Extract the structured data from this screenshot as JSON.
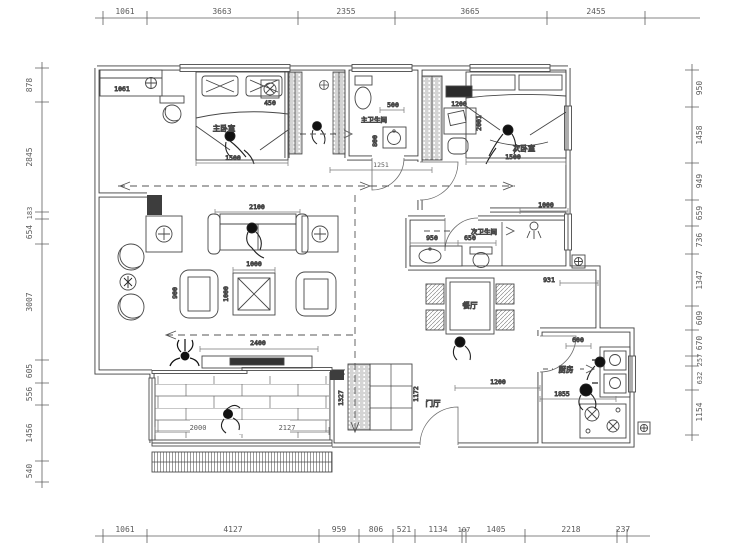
{
  "plan": {
    "type": "apartment-floor-plan",
    "units": "mm"
  },
  "dims": {
    "top": [
      "1061",
      "3663",
      "2355",
      "3665",
      "2455"
    ],
    "bottom": [
      "1061",
      "4127",
      "959",
      "806",
      "521",
      "1134",
      "107",
      "1405",
      "2218",
      "237"
    ],
    "left": [
      "878",
      "2845",
      "183",
      "654",
      "3007",
      "605",
      "556",
      "1456",
      "540"
    ],
    "right": [
      "950",
      "1458",
      "949",
      "659",
      "736",
      "1347",
      "609",
      "670",
      "257",
      "632",
      "1154"
    ],
    "interior": {
      "wardrobe": "1061",
      "fan": "450",
      "bed1": "1500",
      "bath1_w": "500",
      "bath1_d": "800",
      "hall": "1251",
      "desk": "1200",
      "bed2_len": "2001",
      "bed2_w": "1500",
      "sofa": "2100",
      "ctable_w": "1000",
      "ctable_h": "1000",
      "chair": "900",
      "tv": "2400",
      "bath2_sink": "950",
      "bath2_wc": "650",
      "bath2_out": "931",
      "bed2_wall": "1000",
      "kitchen_top": "600",
      "kitchen_w": "1855",
      "entry_w": "1200",
      "entry_cab1": "1327",
      "entry_cab2": "1172",
      "balcony1": "2000",
      "balcony2": "2127"
    }
  },
  "rooms": {
    "master_bedroom": "主卧室",
    "second_bedroom": "次卧室",
    "master_bath": "主卫生间",
    "second_bath": "次卫生间",
    "dining": "餐厅",
    "kitchen": "厨房",
    "foyer": "门厅"
  }
}
